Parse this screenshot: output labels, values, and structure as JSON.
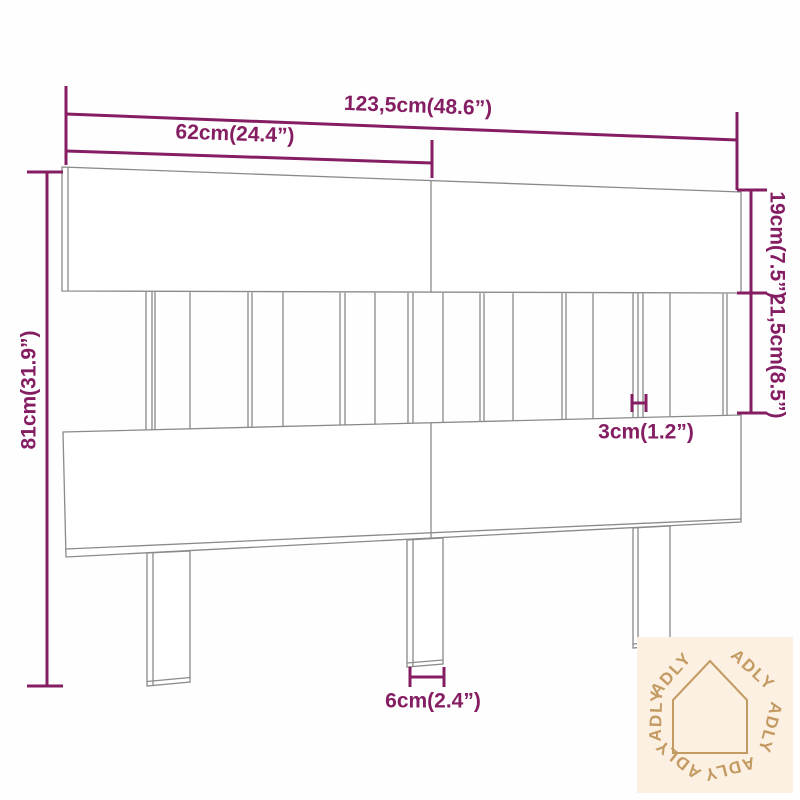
{
  "dimensions": {
    "total_width": "123,5cm(48.6”)",
    "upper_section_width": "62cm(24.4”)",
    "total_height": "81cm(31.9”)",
    "top_board_height": "19cm(7.5”)",
    "middle_section_height": "21,5cm(8.5”)",
    "slat_width": "3cm(1.2”)",
    "leg_width": "6cm(2.4”)"
  },
  "watermark": {
    "brand": "ADLY"
  },
  "colors": {
    "dimension_accent": "#851d63",
    "drawing_line": "#8a8a8a",
    "watermark_bg": "#fbf0e2",
    "watermark_fg": "#c49a63"
  }
}
